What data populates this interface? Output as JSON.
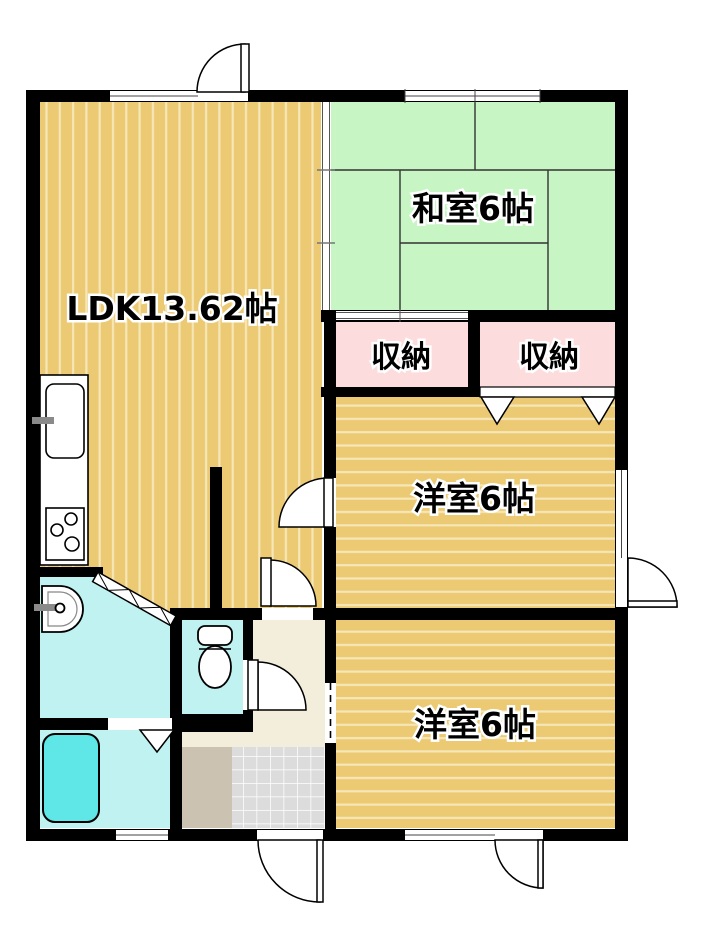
{
  "plan": {
    "type": "floor-plan",
    "rooms": {
      "ldk": {
        "label": "LDK13.62帖"
      },
      "japanese_room": {
        "label": "和室6帖"
      },
      "closet_left": {
        "label": "収納"
      },
      "closet_right": {
        "label": "収納"
      },
      "western_room_middle": {
        "label": "洋室6帖"
      },
      "western_room_bottom": {
        "label": "洋室6帖"
      }
    },
    "fixtures": [
      "kitchen-counter",
      "kitchen-sink",
      "stove",
      "washbasin",
      "toilet",
      "bathtub"
    ],
    "colors": {
      "wall": "#000000",
      "flooring": "#ECC973",
      "flooring_stripe": "#F6E7B8",
      "tatami": "#C7F5C4",
      "tatami_line": "#333333",
      "closet": "#FCDCDD",
      "wet_area": "#BFF2F0",
      "bathtub": "#5FE6E6",
      "hallway": "#F3EDDB",
      "entrance_step": "#CBC2B1",
      "entrance_tile": "#DCDCDC",
      "fixture_outline": "#000000",
      "window_line": "#444444",
      "faucet": "#8A8A8A",
      "white": "#FFFFFF"
    }
  }
}
